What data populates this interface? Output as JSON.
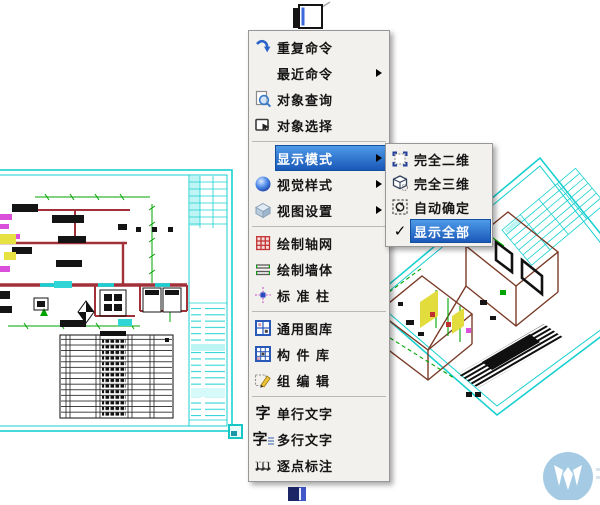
{
  "context_menu": {
    "items": [
      {
        "label": "重复命令",
        "icon": "repeat-command-icon",
        "submenu": false
      },
      {
        "label": "最近命令",
        "icon": "none",
        "submenu": true
      },
      {
        "label": "对象查询",
        "icon": "object-query-icon",
        "submenu": false
      },
      {
        "label": "对象选择",
        "icon": "object-select-icon",
        "submenu": false
      },
      {
        "label": "显示模式",
        "icon": "none",
        "submenu": true,
        "highlighted": true
      },
      {
        "label": "视觉样式",
        "icon": "visual-style-sphere-icon",
        "submenu": true
      },
      {
        "label": "视图设置",
        "icon": "view-settings-box-icon",
        "submenu": true
      },
      {
        "label": "绘制轴网",
        "icon": "draw-axis-grid-icon",
        "submenu": false
      },
      {
        "label": "绘制墙体",
        "icon": "draw-wall-icon",
        "submenu": false
      },
      {
        "label": "标 准 柱",
        "icon": "standard-column-icon",
        "submenu": false
      },
      {
        "label": "通用图库",
        "icon": "general-library-icon",
        "submenu": false
      },
      {
        "label": "构 件 库",
        "icon": "component-library-icon",
        "submenu": false
      },
      {
        "label": "组 编 辑",
        "icon": "group-edit-icon",
        "submenu": false
      },
      {
        "label": "单行文字",
        "icon": "single-line-text-icon",
        "submenu": false
      },
      {
        "label": "多行文字",
        "icon": "multi-line-text-icon",
        "submenu": false
      },
      {
        "label": "逐点标注",
        "icon": "dimension-annotate-icon",
        "submenu": false
      }
    ]
  },
  "submenu": {
    "items": [
      {
        "label": "完全二维",
        "icon": "full-2d-icon"
      },
      {
        "label": "完全三维",
        "icon": "full-3d-icon"
      },
      {
        "label": "自动确定",
        "icon": "auto-determine-icon"
      },
      {
        "label": "显示全部",
        "icon": "check-mark-icon",
        "highlighted": true,
        "checked": true
      }
    ],
    "check_glyph": "✓"
  },
  "icon_glyphs": {
    "text_char": "字"
  },
  "background_drawings": {
    "left": "2d-floor-plan-sheet",
    "right": "3d-axonometric-sheet"
  },
  "colors": {
    "menu_bg": "#f3f1ee",
    "menu_border": "#979797",
    "highlight_top": "#4e9ae8",
    "highlight_bottom": "#1a58b8",
    "text": "#151515",
    "cad_frame_cyan": "#19d0d0",
    "wall_red": "#a23038",
    "dim_green": "#00a400",
    "accent_magenta": "#da50da",
    "accent_yellow": "#e6e242",
    "watermark_blue": "#a5cbe4"
  }
}
